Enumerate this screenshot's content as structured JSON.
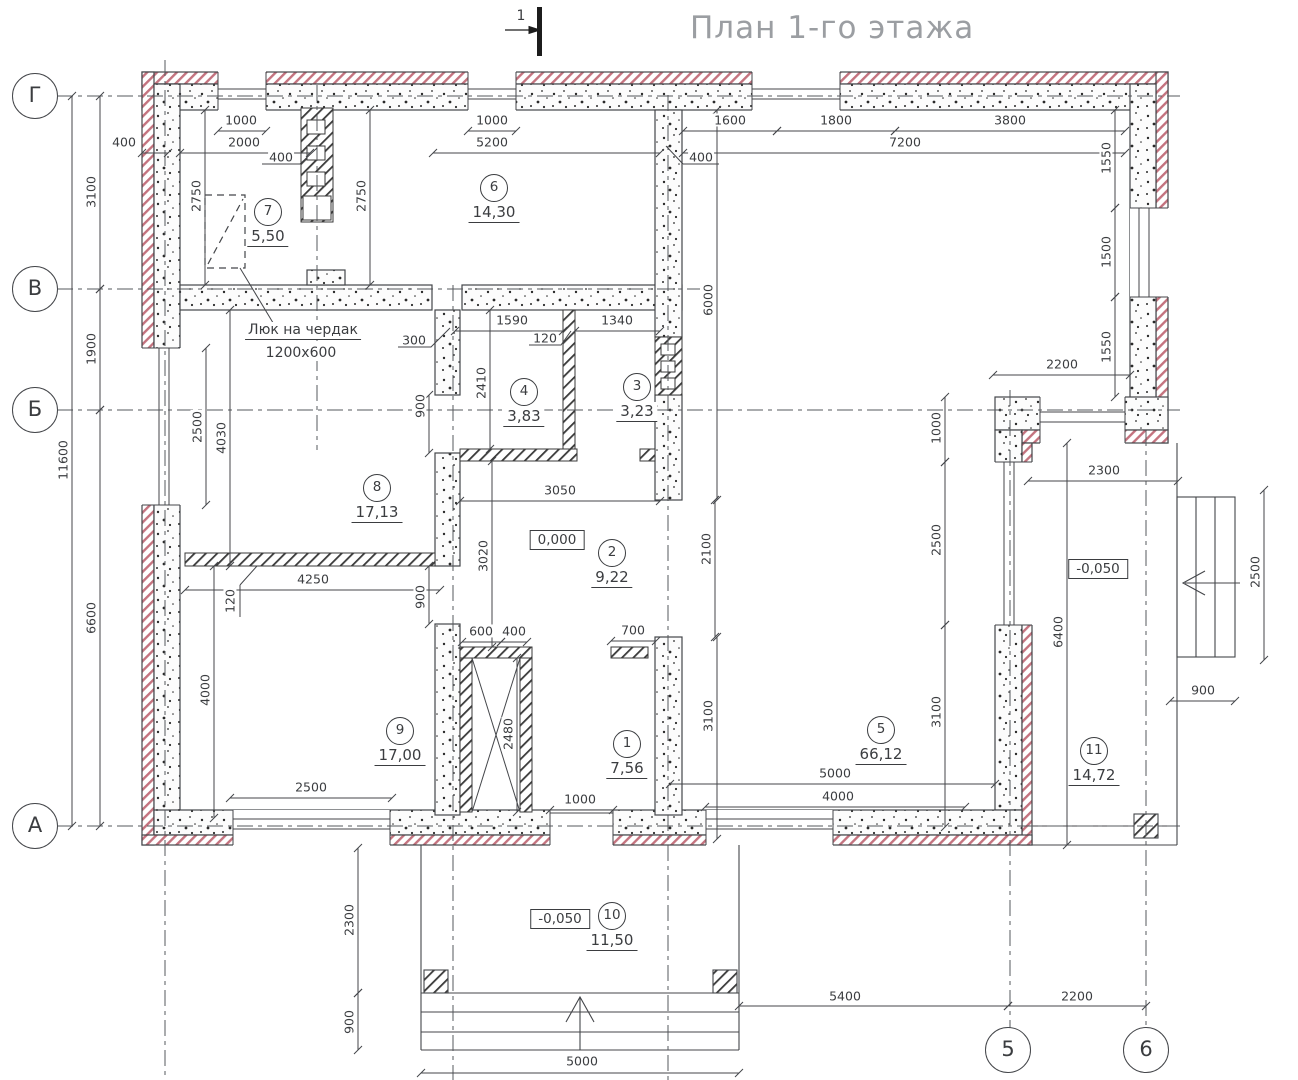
{
  "title": "План 1-го этажа",
  "section_mark": {
    "label": "1"
  },
  "annotation": {
    "line1": "Люк на чердак",
    "line2": "1200x600",
    "x": 303,
    "y": 331
  },
  "colors": {
    "line": "#44464a",
    "insulation_hatch": "#c4737f",
    "text": "#3b3d40",
    "title": "#9b9ea2"
  },
  "axes": {
    "rows": [
      {
        "label": "Г",
        "y": 96
      },
      {
        "label": "В",
        "y": 289
      },
      {
        "label": "Б",
        "y": 410
      },
      {
        "label": "А",
        "y": 826
      }
    ],
    "cols": [
      {
        "label": "5",
        "x": 1008
      },
      {
        "label": "6",
        "x": 1146
      }
    ]
  },
  "rooms": [
    {
      "num": "7",
      "area": "5,50",
      "x": 268,
      "y": 212
    },
    {
      "num": "6",
      "area": "14,30",
      "x": 494,
      "y": 188
    },
    {
      "num": "4",
      "area": "3,83",
      "x": 524,
      "y": 392
    },
    {
      "num": "3",
      "area": "3,23",
      "x": 637,
      "y": 387
    },
    {
      "num": "8",
      "area": "17,13",
      "x": 377,
      "y": 488
    },
    {
      "num": "2",
      "area": "9,22",
      "x": 612,
      "y": 553
    },
    {
      "num": "9",
      "area": "17,00",
      "x": 400,
      "y": 731
    },
    {
      "num": "1",
      "area": "7,56",
      "x": 627,
      "y": 744
    },
    {
      "num": "5",
      "area": "66,12",
      "x": 881,
      "y": 730
    },
    {
      "num": "11",
      "area": "14,72",
      "x": 1094,
      "y": 751
    },
    {
      "num": "10",
      "area": "11,50",
      "x": 612,
      "y": 916
    }
  ],
  "elevations": [
    {
      "value": "0,000",
      "x": 557,
      "y": 540
    },
    {
      "value": "-0,050",
      "x": 1098,
      "y": 569
    },
    {
      "value": "-0,050",
      "x": 560,
      "y": 919
    }
  ],
  "dimensions": [
    {
      "t": "1000",
      "x": 241,
      "y": 120,
      "line": [
        218,
        131,
        266,
        131
      ]
    },
    {
      "t": "2000",
      "x": 244,
      "y": 142,
      "line": [
        180,
        153,
        310,
        153
      ]
    },
    {
      "t": "400",
      "x": 124,
      "y": 142,
      "line": [
        142,
        153,
        168,
        153
      ]
    },
    {
      "t": "400",
      "x": 281,
      "y": 157
    },
    {
      "t": "1000",
      "x": 492,
      "y": 120,
      "line": [
        468,
        131,
        516,
        131
      ]
    },
    {
      "t": "5200",
      "x": 492,
      "y": 142,
      "line": [
        433,
        153,
        660,
        153
      ]
    },
    {
      "t": "1600",
      "x": 730,
      "y": 120,
      "line": [
        683,
        131,
        777,
        131
      ]
    },
    {
      "t": "1800",
      "x": 836,
      "y": 120,
      "line": [
        777,
        131,
        895,
        131
      ]
    },
    {
      "t": "3800",
      "x": 1010,
      "y": 120,
      "line": [
        895,
        131,
        1125,
        131
      ]
    },
    {
      "t": "7200",
      "x": 905,
      "y": 142,
      "line": [
        683,
        153,
        1125,
        153
      ]
    },
    {
      "t": "400",
      "x": 701,
      "y": 157
    },
    {
      "t": "1550",
      "x": 1106,
      "y": 158,
      "rot": 90,
      "line": [
        1115,
        110,
        1115,
        208
      ]
    },
    {
      "t": "1500",
      "x": 1106,
      "y": 252,
      "rot": 90,
      "line": [
        1115,
        208,
        1115,
        297
      ]
    },
    {
      "t": "1550",
      "x": 1106,
      "y": 347,
      "rot": 90,
      "line": [
        1115,
        297,
        1115,
        397
      ]
    },
    {
      "t": "2200",
      "x": 1062,
      "y": 364,
      "line": [
        993,
        375,
        1130,
        375
      ]
    },
    {
      "t": "3100",
      "x": 91,
      "y": 192,
      "rot": 90,
      "line": [
        100,
        96,
        100,
        289
      ]
    },
    {
      "t": "1900",
      "x": 91,
      "y": 349,
      "rot": 90,
      "line": [
        100,
        289,
        100,
        410
      ]
    },
    {
      "t": "6600",
      "x": 91,
      "y": 618,
      "rot": 90,
      "line": [
        100,
        410,
        100,
        826
      ]
    },
    {
      "t": "11600",
      "x": 63,
      "y": 460,
      "rot": 90,
      "line": [
        72,
        96,
        72,
        826
      ]
    },
    {
      "t": "2750",
      "x": 196,
      "y": 196,
      "rot": 90,
      "line": [
        205,
        110,
        205,
        285
      ]
    },
    {
      "t": "2750",
      "x": 361,
      "y": 196,
      "rot": 90,
      "line": [
        370,
        110,
        370,
        285
      ]
    },
    {
      "t": "2500",
      "x": 197,
      "y": 427,
      "rot": 90,
      "line": [
        206,
        348,
        206,
        505
      ]
    },
    {
      "t": "4030",
      "x": 221,
      "y": 438,
      "rot": 90,
      "line": [
        230,
        310,
        230,
        566
      ]
    },
    {
      "t": "4000",
      "x": 205,
      "y": 690,
      "rot": 90,
      "line": [
        214,
        566,
        214,
        818
      ]
    },
    {
      "t": "2500",
      "x": 311,
      "y": 787,
      "line": [
        230,
        798,
        392,
        798
      ]
    },
    {
      "t": "1590",
      "x": 512,
      "y": 320,
      "line": [
        455,
        331,
        563,
        331
      ]
    },
    {
      "t": "120",
      "x": 545,
      "y": 338
    },
    {
      "t": "1340",
      "x": 617,
      "y": 320,
      "line": [
        575,
        331,
        660,
        331
      ]
    },
    {
      "t": "300",
      "x": 414,
      "y": 340
    },
    {
      "t": "2410",
      "x": 481,
      "y": 383,
      "rot": 90,
      "line": [
        490,
        310,
        490,
        449
      ]
    },
    {
      "t": "900",
      "x": 420,
      "y": 406,
      "rot": 90,
      "line": [
        429,
        395,
        429,
        453
      ]
    },
    {
      "t": "3050",
      "x": 560,
      "y": 490,
      "line": [
        460,
        501,
        660,
        501
      ]
    },
    {
      "t": "3020",
      "x": 483,
      "y": 556,
      "rot": 90,
      "line": [
        492,
        461,
        492,
        647
      ]
    },
    {
      "t": "900",
      "x": 420,
      "y": 597,
      "rot": 90,
      "line": [
        429,
        566,
        429,
        624
      ]
    },
    {
      "t": "4250",
      "x": 313,
      "y": 579,
      "line": [
        185,
        590,
        440,
        590
      ]
    },
    {
      "t": "120",
      "x": 230,
      "y": 601,
      "rot": 90
    },
    {
      "t": "600",
      "x": 481,
      "y": 631,
      "line": [
        462,
        642,
        501,
        642
      ]
    },
    {
      "t": "400",
      "x": 514,
      "y": 631,
      "line": [
        501,
        642,
        527,
        642
      ]
    },
    {
      "t": "700",
      "x": 633,
      "y": 630,
      "line": [
        611,
        641,
        656,
        641
      ]
    },
    {
      "t": "2480",
      "x": 508,
      "y": 734,
      "rot": 90,
      "line": [
        517,
        658,
        517,
        812
      ]
    },
    {
      "t": "1000",
      "x": 580,
      "y": 799,
      "line": [
        550,
        810,
        613,
        810
      ]
    },
    {
      "t": "6000",
      "x": 708,
      "y": 300,
      "rot": 90,
      "line": [
        717,
        110,
        717,
        500
      ]
    },
    {
      "t": "2100",
      "x": 706,
      "y": 549,
      "rot": 90,
      "line": [
        715,
        500,
        715,
        637
      ]
    },
    {
      "t": "3100",
      "x": 708,
      "y": 716,
      "rot": 90,
      "line": [
        717,
        637,
        717,
        839
      ]
    },
    {
      "t": "1000",
      "x": 936,
      "y": 428,
      "rot": 90,
      "line": [
        945,
        397,
        945,
        462
      ]
    },
    {
      "t": "2500",
      "x": 936,
      "y": 540,
      "rot": 90,
      "line": [
        945,
        462,
        945,
        625
      ]
    },
    {
      "t": "3100",
      "x": 936,
      "y": 712,
      "rot": 90,
      "line": [
        945,
        625,
        945,
        827
      ]
    },
    {
      "t": "2300",
      "x": 1104,
      "y": 470,
      "line": [
        1028,
        481,
        1178,
        481
      ]
    },
    {
      "t": "6400",
      "x": 1058,
      "y": 632,
      "rot": 90,
      "line": [
        1067,
        443,
        1067,
        845
      ]
    },
    {
      "t": "2500",
      "x": 1255,
      "y": 572,
      "rot": 90,
      "line": [
        1264,
        490,
        1264,
        660
      ]
    },
    {
      "t": "900",
      "x": 1203,
      "y": 690,
      "line": [
        1170,
        701,
        1235,
        701
      ]
    },
    {
      "t": "5000",
      "x": 835,
      "y": 773,
      "line": [
        670,
        784,
        995,
        784
      ]
    },
    {
      "t": "4000",
      "x": 838,
      "y": 796,
      "line": [
        705,
        807,
        965,
        807
      ]
    },
    {
      "t": "2300",
      "x": 349,
      "y": 920,
      "rot": 90,
      "line": [
        358,
        848,
        358,
        993
      ]
    },
    {
      "t": "900",
      "x": 349,
      "y": 1022,
      "rot": 90,
      "line": [
        358,
        993,
        358,
        1050
      ]
    },
    {
      "t": "5000",
      "x": 582,
      "y": 1061,
      "line": [
        421,
        1073,
        739,
        1073
      ]
    },
    {
      "t": "5400",
      "x": 845,
      "y": 996,
      "line": [
        739,
        1006,
        1008,
        1006
      ]
    },
    {
      "t": "2200",
      "x": 1077,
      "y": 996,
      "line": [
        1008,
        1006,
        1146,
        1006
      ]
    }
  ]
}
